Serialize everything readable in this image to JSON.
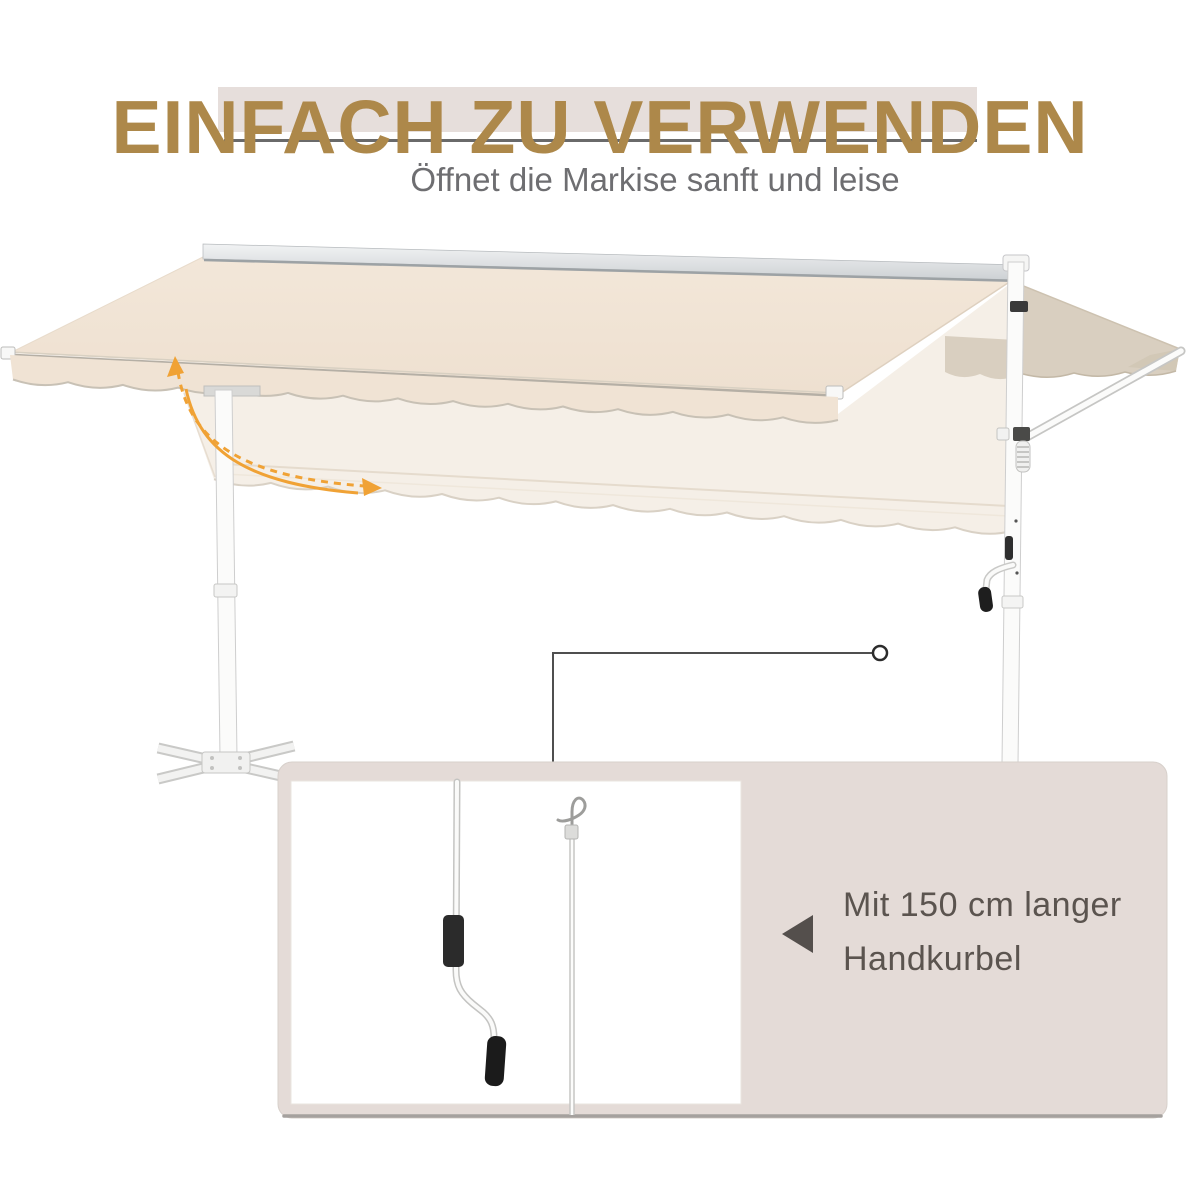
{
  "header": {
    "title": "EINFACH ZU VERWENDEN",
    "subtitle": "Öffnet die Markise sanft und leise",
    "title_color": "#ad884a",
    "band_color": "#e6dedb"
  },
  "annotation": {
    "crank_note_line1": "Mit 150 cm langer",
    "crank_note_line2": "Handkurbel",
    "text_color": "#5b544f"
  },
  "colors": {
    "canopy_beige": "#f1e4d5",
    "ghost_canopy": "#f5efe7",
    "side_wing_taupe": "#d9cfc0",
    "arrow_orange": "#f0a235",
    "panel_background": "#e4dbd7",
    "frame_white": "#fbfbfa",
    "underline_gray": "#6a6a6a"
  }
}
